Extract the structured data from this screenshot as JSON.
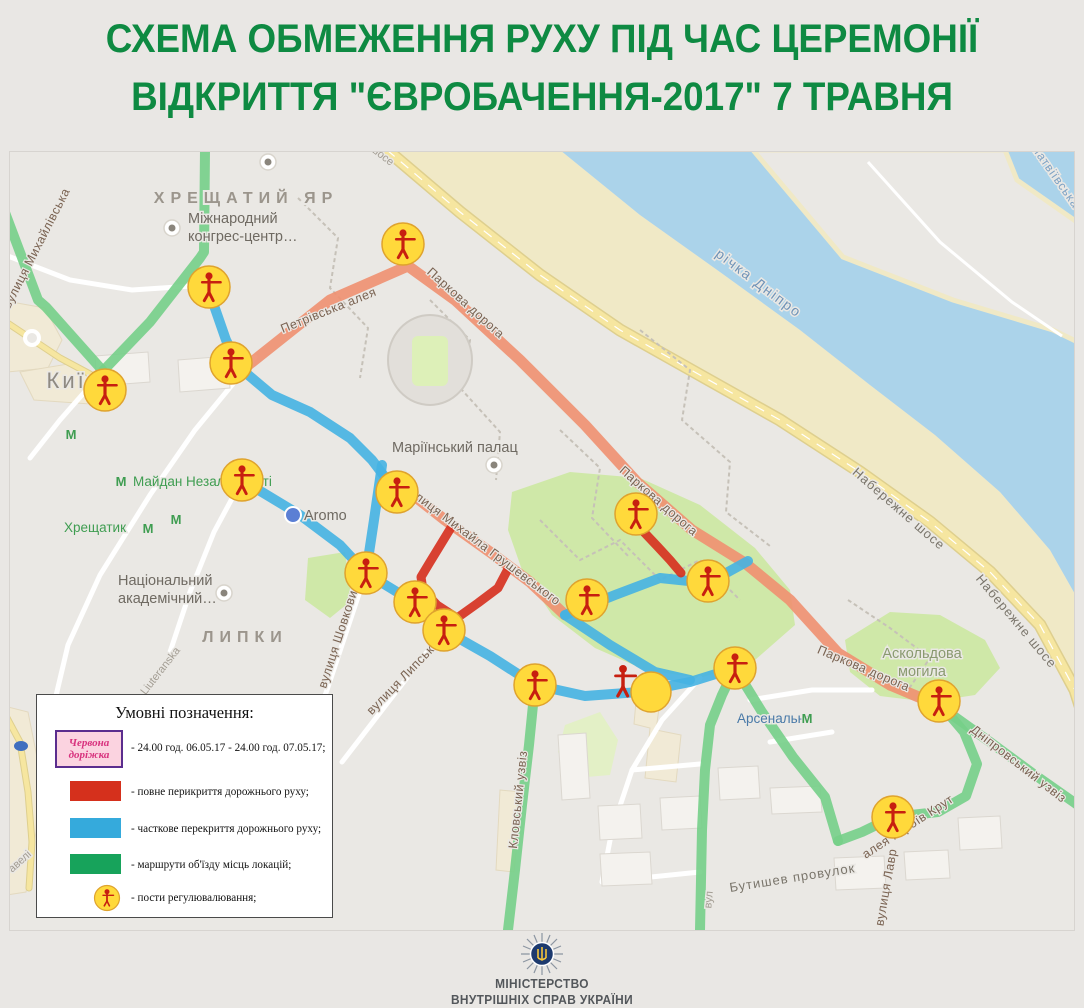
{
  "title": {
    "line1": "СХЕМА ОБМЕЖЕННЯ РУХУ ПІД ЧАС ЦЕРЕМОНІЇ",
    "line2": "ВІДКРИТТЯ \"ЄВРОБАЧЕННЯ-2017\" 7 ТРАВНЯ"
  },
  "legend": {
    "title": "Умовні позначення:",
    "red_carpet_label": "Червона доріжка",
    "items": [
      {
        "text": "- 24.00 год. 06.05.17 - 24.00 год. 07.05.17;"
      },
      {
        "text": "- повне перикриття дорожнього руху;"
      },
      {
        "text": "- часткове перекриття дорожнього руху;"
      },
      {
        "text": "- маршрути об'їзду місць локацій;"
      },
      {
        "text": "- пости регулювалювання;"
      }
    ]
  },
  "footer": {
    "line1": "МІНІСТЕРСТВО",
    "line2": "ВНУТРІШНІХ СПРАВ УКРАЇНИ"
  },
  "map": {
    "colors": {
      "land": "#eae8e4",
      "water": "#abd3ea",
      "park": "#cfe8a8",
      "park_pale": "#e3f0c6",
      "beach": "#f0e9c6",
      "yellow_road": "#f6e6a0",
      "white_road": "#ffffff",
      "trail": "#c6c1b8",
      "building": "#f4f2ee",
      "building_edge": "#dbd7d0",
      "beige": "#f1ead6",
      "beige_edge": "#e3d9bf",
      "route_green": "#76cf88",
      "route_blue": "#45b2e2",
      "route_orange": "#f09070",
      "route_red": "#d62f1d",
      "post_yellow": "#ffd93b",
      "post_rim": "#dfa32e",
      "figure_red": "#c71f10"
    },
    "shapes": {
      "water": [
        560,
        150,
        640,
        215,
        720,
        272,
        800,
        330,
        870,
        385,
        935,
        435,
        1000,
        492,
        1050,
        550,
        1084,
        610,
        1084,
        150
      ],
      "beach": [
        387,
        150,
        460,
        212,
        540,
        275,
        620,
        330,
        700,
        375,
        780,
        420,
        860,
        472,
        930,
        522,
        990,
        572,
        1040,
        625,
        1075,
        690,
        1084,
        718,
        1084,
        610,
        1050,
        550,
        1000,
        492,
        935,
        435,
        870,
        385,
        800,
        330,
        720,
        272,
        640,
        215,
        560,
        150
      ],
      "island": [
        753,
        150,
        843,
        257,
        953,
        300,
        1053,
        330,
        1084,
        345,
        1084,
        227,
        1017,
        180,
        1005,
        150
      ],
      "parks": [
        [
          512,
          492,
          570,
          472,
          640,
          478,
          700,
          505,
          755,
          548,
          790,
          590,
          795,
          625,
          755,
          660,
          700,
          678,
          645,
          670,
          595,
          648,
          552,
          615,
          522,
          570,
          508,
          530
        ],
        [
          845,
          640,
          890,
          612,
          940,
          615,
          985,
          640,
          1000,
          668,
          975,
          695,
          930,
          702,
          880,
          696,
          850,
          672
        ],
        [
          308,
          558,
          345,
          552,
          352,
          600,
          330,
          618,
          305,
          600
        ]
      ],
      "parks_pale": [
        [
          565,
          725,
          600,
          712,
          618,
          740,
          610,
          775,
          575,
          778,
          558,
          752
        ]
      ],
      "beige": [
        [
          0,
          300,
          45,
          308,
          62,
          340,
          48,
          368,
          8,
          372,
          0,
          362
        ],
        [
          20,
          372,
          68,
          364,
          96,
          382,
          90,
          404,
          34,
          400
        ],
        [
          0,
          705,
          28,
          712,
          38,
          762,
          36,
          832,
          26,
          892,
          0,
          896
        ],
        [
          637,
          690,
          661,
          694,
          656,
          730,
          681,
          735,
          676,
          782,
          645,
          778,
          650,
          728,
          634,
          724
        ],
        [
          500,
          790,
          522,
          792,
          514,
          872,
          496,
          870
        ]
      ],
      "buildings": [
        [
          558,
          735,
          586,
          733,
          590,
          798,
          562,
          800
        ],
        [
          598,
          806,
          640,
          804,
          642,
          838,
          600,
          840
        ],
        [
          660,
          798,
          700,
          796,
          702,
          828,
          662,
          830
        ],
        [
          718,
          768,
          758,
          766,
          760,
          798,
          720,
          800
        ],
        [
          770,
          788,
          820,
          786,
          822,
          812,
          772,
          814
        ],
        [
          834,
          858,
          884,
          856,
          886,
          888,
          836,
          890
        ],
        [
          904,
          852,
          948,
          850,
          950,
          878,
          906,
          880
        ],
        [
          958,
          818,
          1000,
          816,
          1002,
          848,
          960,
          850
        ],
        [
          600,
          854,
          650,
          852,
          652,
          884,
          602,
          886
        ],
        [
          95,
          356,
          148,
          352,
          150,
          382,
          97,
          386
        ],
        [
          178,
          360,
          228,
          356,
          230,
          388,
          180,
          392
        ]
      ]
    },
    "roads": {
      "yellow": [
        [
          387,
          150,
          460,
          212,
          540,
          275,
          620,
          330,
          700,
          375,
          780,
          420,
          860,
          472,
          930,
          522,
          990,
          572,
          1040,
          625,
          1075,
          690,
          1084,
          718
        ],
        [
          6,
          716,
          20,
          742,
          28,
          792,
          32,
          842,
          29,
          888
        ],
        [
          0,
          318,
          30,
          338,
          60,
          358,
          90,
          374,
          105,
          388
        ]
      ],
      "white": [
        [
          255,
          357,
          195,
          430,
          150,
          495,
          100,
          575,
          68,
          645,
          55,
          700
        ],
        [
          366,
          573,
          327,
          690,
          300,
          762
        ],
        [
          444,
          630,
          396,
          692,
          342,
          762
        ],
        [
          242,
          480,
          214,
          532,
          190,
          592,
          170,
          652
        ],
        [
          700,
          678,
          662,
          720,
          632,
          770,
          612,
          830,
          602,
          882
        ],
        [
          602,
          882,
          700,
          872
        ],
        [
          632,
          770,
          700,
          764
        ],
        [
          750,
          700,
          812,
          690,
          872,
          690
        ],
        [
          770,
          742,
          832,
          732
        ],
        [
          8,
          256,
          70,
          280,
          132,
          290,
          192,
          286
        ],
        [
          103,
          371,
          60,
          420,
          30,
          458
        ]
      ],
      "island_path": [
        868,
        162,
        940,
        242,
        1012,
        302,
        1062,
        336
      ],
      "trails": [
        [
          298,
          198,
          338,
          238,
          330,
          288,
          368,
          328,
          360,
          378
        ],
        [
          640,
          330,
          690,
          370,
          682,
          420,
          730,
          462,
          726,
          512,
          770,
          546
        ],
        [
          430,
          300,
          470,
          340,
          462,
          390,
          500,
          432,
          496,
          480
        ],
        [
          848,
          600,
          890,
          628,
          930,
          658,
          908,
          690
        ],
        [
          560,
          430,
          600,
          468,
          592,
          518,
          630,
          558
        ],
        [
          540,
          520,
          580,
          560,
          620,
          540,
          660,
          580,
          700,
          560,
          740,
          600
        ]
      ]
    },
    "routes": {
      "orange": [
        [
          242,
          370,
          330,
          300,
          408,
          266,
          455,
          300,
          520,
          360,
          585,
          425,
          637,
          482,
          692,
          530,
          745,
          563,
          790,
          600,
          838,
          653,
          890,
          685,
          940,
          706
        ],
        [
          403,
          487,
          445,
          520,
          490,
          552,
          530,
          582,
          565,
          615
        ]
      ],
      "blue": [
        [
          210,
          294,
          226,
          340,
          240,
          368,
          272,
          395,
          310,
          412,
          350,
          438,
          372,
          460,
          397,
          493
        ],
        [
          242,
          480,
          300,
          515,
          340,
          545,
          366,
          573,
          415,
          603,
          444,
          630,
          490,
          656,
          535,
          685,
          585,
          696,
          640,
          692,
          690,
          682,
          735,
          668
        ],
        [
          382,
          465,
          374,
          520,
          366,
          573
        ],
        [
          565,
          615,
          610,
          645,
          655,
          672,
          690,
          680
        ],
        [
          565,
          615,
          615,
          595,
          660,
          578,
          708,
          583,
          748,
          561
        ]
      ],
      "red": [
        [
          452,
          526,
          430,
          562,
          421,
          577,
          423,
          590,
          437,
          605,
          457,
          618,
          478,
          603,
          498,
          588,
          508,
          569
        ],
        [
          641,
          529,
          658,
          547,
          670,
          560,
          681,
          573
        ]
      ],
      "green": [
        [
          -5,
          186,
          38,
          300,
          46,
          307,
          103,
          371
        ],
        [
          103,
          371,
          150,
          322,
          200,
          258,
          204,
          252,
          205,
          150
        ],
        [
          535,
          685,
          529,
          745,
          522,
          805,
          515,
          870,
          508,
          930
        ],
        [
          735,
          668,
          762,
          712,
          793,
          757,
          825,
          797,
          838,
          841
        ],
        [
          941,
          705,
          964,
          732,
          977,
          764,
          966,
          796,
          938,
          812,
          893,
          817,
          862,
          832,
          838,
          841
        ],
        [
          948,
          712,
          990,
          742,
          1035,
          775,
          1075,
          803,
          1084,
          810
        ],
        [
          735,
          668,
          722,
          695,
          710,
          725,
          705,
          770,
          702,
          830,
          700,
          930
        ]
      ]
    },
    "posts": [
      [
        403,
        244
      ],
      [
        209,
        287
      ],
      [
        231,
        363
      ],
      [
        105,
        390
      ],
      [
        242,
        480
      ],
      [
        397,
        492
      ],
      [
        636,
        514
      ],
      [
        366,
        573
      ],
      [
        708,
        581
      ],
      [
        415,
        602
      ],
      [
        444,
        630
      ],
      [
        587,
        600
      ],
      [
        535,
        685
      ],
      [
        735,
        668
      ],
      [
        939,
        701
      ],
      [
        893,
        817
      ]
    ],
    "figure_only": [
      623,
      681
    ],
    "empty_circle": [
      651,
      692
    ],
    "metro_icons": [
      [
        121,
        481
      ],
      [
        148,
        528
      ],
      [
        176,
        519
      ],
      [
        807,
        718
      ],
      [
        71,
        434
      ],
      [
        733,
        654
      ]
    ],
    "pois": [
      {
        "kind": "gray",
        "x": 172,
        "y": 228
      },
      {
        "kind": "gray",
        "x": 494,
        "y": 465
      },
      {
        "kind": "gray",
        "x": 224,
        "y": 593
      },
      {
        "kind": "gray",
        "x": 268,
        "y": 162
      },
      {
        "kind": "blue",
        "x": 293,
        "y": 515
      }
    ],
    "labels": [
      {
        "t": "ХРЕЩАТИЙ ЯР",
        "x": 246,
        "y": 203,
        "c": "area"
      },
      {
        "t": "Міжнародний",
        "x": 188,
        "y": 223,
        "c": "poi"
      },
      {
        "t": "конгрес-центр…",
        "x": 188,
        "y": 241,
        "c": "poi"
      },
      {
        "t": "Київ",
        "x": 74,
        "y": 388,
        "c": "city"
      },
      {
        "t": "Майдан Незалежності",
        "x": 133,
        "y": 486,
        "c": "metro"
      },
      {
        "t": "Хрещатик",
        "x": 64,
        "y": 532,
        "c": "metro"
      },
      {
        "t": "Національний",
        "x": 118,
        "y": 585,
        "c": "poi"
      },
      {
        "t": "академічний…",
        "x": 118,
        "y": 603,
        "c": "poi"
      },
      {
        "t": "ЛИПКИ",
        "x": 245,
        "y": 642,
        "c": "area"
      },
      {
        "t": "Liuteranska",
        "x": 163,
        "y": 673,
        "c": "small",
        "r": -52
      },
      {
        "t": "Aromo",
        "x": 304,
        "y": 520,
        "c": "poi"
      },
      {
        "t": "Маріїнський палац",
        "x": 392,
        "y": 452,
        "c": "poi"
      },
      {
        "t": "річка Дніпро",
        "x": 756,
        "y": 287,
        "c": "water",
        "r": 37
      },
      {
        "t": "Матвіївська",
        "x": 1052,
        "y": 178,
        "c": "water2",
        "r": 55
      },
      {
        "t": "Набережне шосе",
        "x": 896,
        "y": 512,
        "c": "road",
        "r": 41
      },
      {
        "t": "Набережне шосе",
        "x": 1013,
        "y": 624,
        "c": "road",
        "r": 50
      },
      {
        "t": "шосе",
        "x": 380,
        "y": 158,
        "c": "small",
        "r": 38
      },
      {
        "t": "Петрівська алея",
        "x": 330,
        "y": 314,
        "c": "rlabel",
        "r": -22
      },
      {
        "t": "Паркова дорога",
        "x": 463,
        "y": 306,
        "c": "rlabel",
        "r": 42
      },
      {
        "t": "Паркова дорога",
        "x": 656,
        "y": 504,
        "c": "rlabel",
        "r": 41
      },
      {
        "t": "Паркова дорога",
        "x": 862,
        "y": 672,
        "c": "rlabel",
        "r": 23
      },
      {
        "t": "вулиця Михайла Грушевського",
        "x": 480,
        "y": 548,
        "c": "rlabel",
        "r": 37
      },
      {
        "t": "вулиця Шовковична",
        "x": 345,
        "y": 630,
        "c": "rlabel",
        "r": -72
      },
      {
        "t": "вулиця Липська",
        "x": 406,
        "y": 680,
        "c": "rlabel",
        "r": -46
      },
      {
        "t": "Кловський узвіз",
        "x": 522,
        "y": 800,
        "c": "rlabel",
        "r": -84
      },
      {
        "t": "Дніпровський узвіз",
        "x": 1016,
        "y": 767,
        "c": "rlabel",
        "r": 38
      },
      {
        "t": "алея Героїв Крут",
        "x": 910,
        "y": 830,
        "c": "rlabel",
        "r": -33
      },
      {
        "t": "Бутишев провулок",
        "x": 793,
        "y": 882,
        "c": "road",
        "r": -9
      },
      {
        "t": "вулиця Лавр",
        "x": 890,
        "y": 888,
        "c": "rlabel",
        "r": -80
      },
      {
        "t": "Арсенальна",
        "x": 737,
        "y": 723,
        "c": "arsenal"
      },
      {
        "t": "Аскольдова",
        "x": 922,
        "y": 658,
        "c": "park"
      },
      {
        "t": "могила",
        "x": 922,
        "y": 676,
        "c": "park"
      },
      {
        "t": "вулиця Михайлівська",
        "x": 40,
        "y": 250,
        "c": "rlabel",
        "r": -63
      },
      {
        "t": "авелі",
        "x": 22,
        "y": 864,
        "c": "small",
        "r": -42
      },
      {
        "t": "вул",
        "x": 712,
        "y": 900,
        "c": "small",
        "r": -85
      }
    ]
  }
}
